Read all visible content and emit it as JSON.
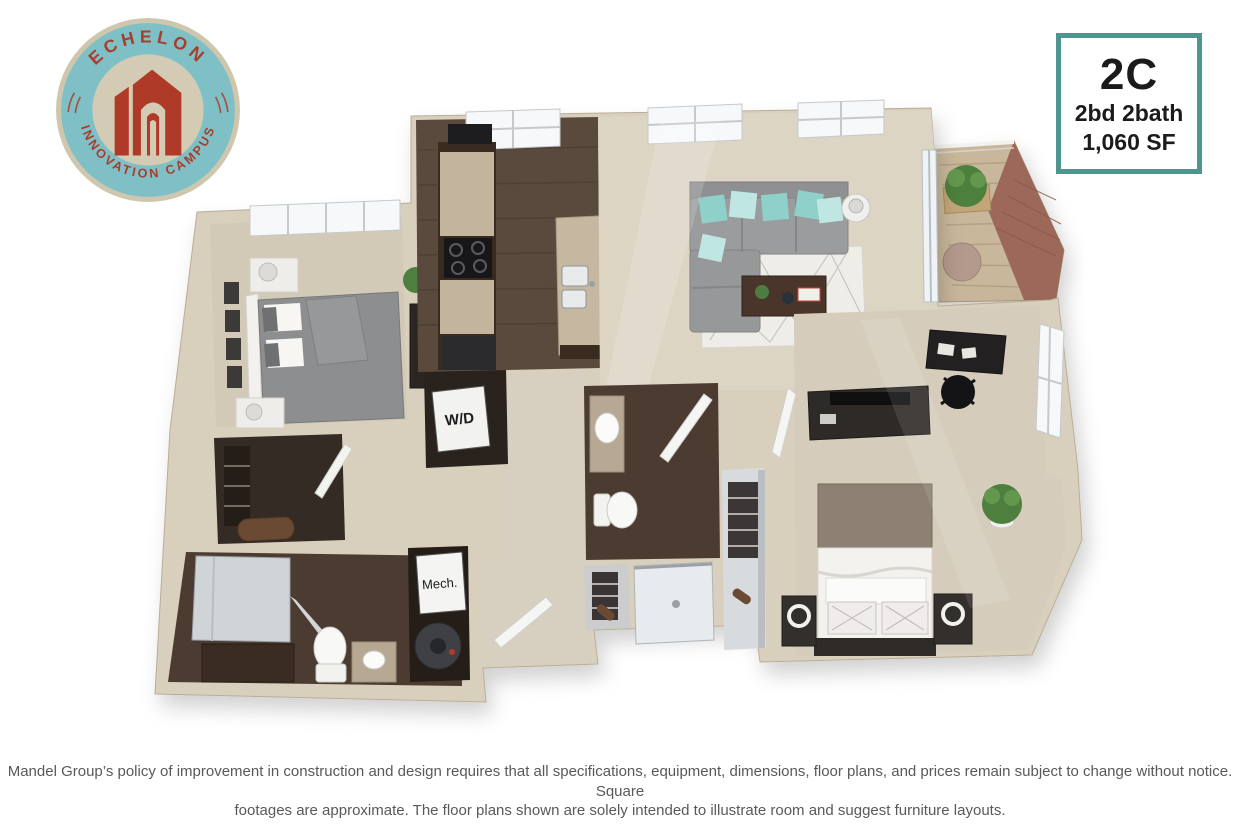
{
  "logo": {
    "arc_top": "ECHELON",
    "arc_bottom": "INNOVATION CAMPUS",
    "colors": {
      "ring": "#7fc0c6",
      "ring_border": "#cfc6ae",
      "inner": "#d4cbb4",
      "text_red": "#a93d2b",
      "building_red": "#b03a28"
    }
  },
  "unit_card": {
    "unit_label": "2C",
    "beds_baths": "2bd 2bath",
    "square_feet": "1,060 SF",
    "border_color": "#4e9591"
  },
  "floorplan": {
    "washer_dryer_label": "W/D",
    "mechanical_label": "Mech.",
    "palette": {
      "wall": "#d8cfbd",
      "wall_shade": "#c2b7a1",
      "carpet": "#d7cfc0",
      "dark_wood": "#5a4a3d",
      "granite": "#c3b49e",
      "sofa_gray": "#9a9b9d",
      "pillow_teal": "#8fd0cb",
      "stool_red": "#b23a31",
      "rug_white": "#efede8",
      "balcony_brick": "#9c685a",
      "balcony_deck": "#c9b79b"
    }
  },
  "disclaimer": {
    "line1": "Mandel Group’s policy of improvement in construction and design requires that all specifications, equipment, dimensions, floor plans, and prices remain subject to change without notice. Square",
    "line2": "footages are approximate. The floor plans shown are solely intended to illustrate room and suggest furniture layouts."
  }
}
